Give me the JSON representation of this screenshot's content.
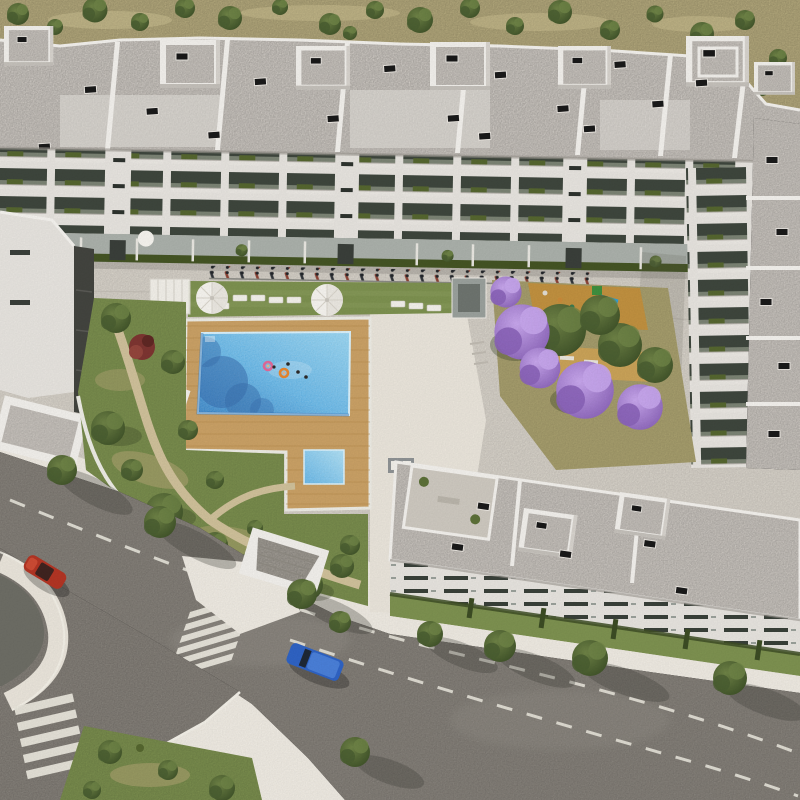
{
  "meta": {
    "type": "aerial-architectural-render",
    "subject": "bird's-eye 3D rendering of a modern white residential apartment complex with central courtyard, swimming pool, gardens, jacaranda trees and surrounding streets",
    "no_visible_text": true
  },
  "colors": {
    "terrain": "#b3a87c",
    "terrainDry": "#c9bd90",
    "scrub": "#4e6030",
    "treeLight": "#6e8246",
    "treeDark": "#3e5128",
    "lawn": "#7d9150",
    "lawnDry": "#aba270",
    "roof": "#cfcac4",
    "roofLight": "#dcd8d3",
    "parapet": "#f1efeb",
    "facade": "#e6e3de",
    "slab": "#e9e6e1",
    "balconyDark": "#3e463d",
    "rail": "#7b8374",
    "hedge": "#55662f",
    "hedgeDark": "#445424",
    "terraceFloor": "#aab0aa",
    "paving": "#d7d2c9",
    "sidewalk": "#e9e4da",
    "asphalt": "#8a857e",
    "asphaltDark": "#6d6d65",
    "roadLine": "#e7e4da",
    "deck": "#c9a065",
    "deckLine": "#b58a4e",
    "poolLight": "#8fd0ee",
    "poolMid": "#5db1e4",
    "poolDeep": "#2f7fc4",
    "poolShadow": "#3a6fae",
    "umbrella": "#f5f3ee",
    "jacLight": "#c7a6ec",
    "jacMid": "#a77fd6",
    "jacDark": "#8a63b8",
    "playSand": "#c0903f",
    "carRed": "#b23524",
    "carBlue": "#2f63c4",
    "kiosk": "#9aa09c",
    "rampDark": "#43443f",
    "redTree": "#7d3531"
  },
  "objects": {
    "scrubland_strip": "dry scrubland with shrubs along the top edge",
    "north_block": "long white apartment building, gravel flat roofs, penthouse roof boxes, balconies with hedges",
    "east_wing": "apartment wing on the right with balconies and gravel roof",
    "south_block": "apartment block at bottom with gravel roof, roof terraces and slit-window facade",
    "west_structures": "low white buildings, access ramp and service cabin on the left",
    "central_garden": "landscaped garden with winding paths, green trees and one red-leaf tree",
    "pool_area": "rectangular blue pool on a wooden deck, kids pool, lawn with two white umbrellas and sun loungers, pergola, elevator kiosk",
    "swimmers": "people bathing, two on swim rings (pink and orange)",
    "playground": "sand playground with play equipment beside purple jacaranda trees",
    "jacarandas": "cluster of blooming purple jacaranda trees",
    "bike_racks": "row of parked bicycles along the courtyard walkway",
    "main_road": "asphalt avenue with dashed lane lines running diagonally bottom-left to bottom-right",
    "side_road_roundabout": "roundabout and exit road at the lower left corner",
    "zebra_crossings": "two white zebra pedestrian crossings",
    "red_car": "red car driving near the roundabout",
    "blue_van": "blue van driving on the avenue",
    "street_trees": "street trees with long shadows on sidewalks",
    "green_median": "green planted median triangle at bottom left"
  },
  "counts": {
    "umbrellas": 2,
    "sun_loungers": 8,
    "swimmers": 6,
    "pool_floats": 2,
    "pools": 2,
    "cars": 2,
    "zebra_crossings": 2,
    "jacaranda_trees": 4,
    "penthouse_roof_boxes": 7,
    "playgrounds": 1
  }
}
